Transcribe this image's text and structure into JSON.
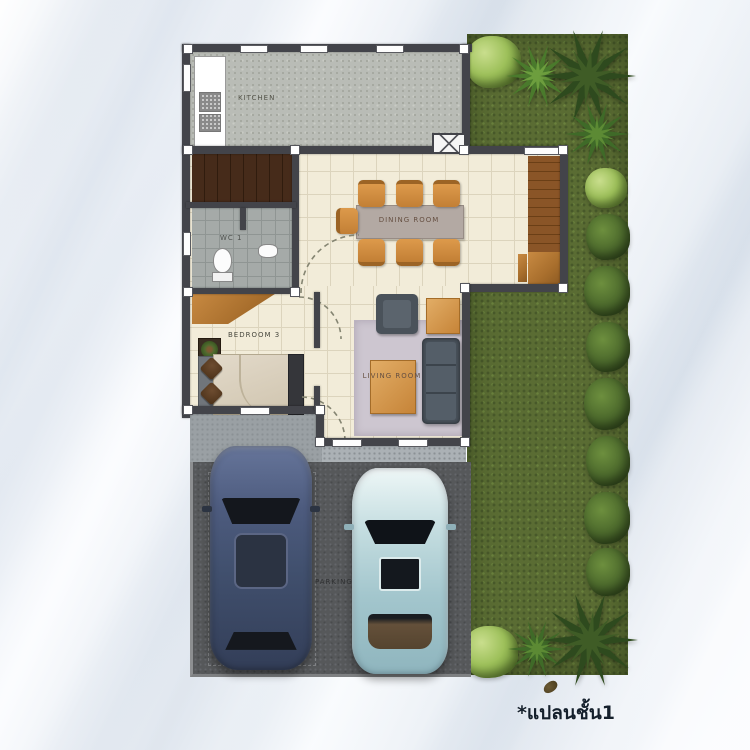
{
  "plan": {
    "caption": "*แปลนชั้น1",
    "rooms": {
      "kitchen": "KITCHEN",
      "dining": "DINING ROOM",
      "wc": "WC 1",
      "bedroom": "BEDROOM 3",
      "living": "LIVING ROOM",
      "parking": "PARKING"
    },
    "colors": {
      "sand_background": "#eef1f5",
      "grass": "#5a6c33",
      "wall": "#43444a",
      "tile_floor": "#f2ecd9",
      "kitchen_floor": "#b9bcb6",
      "wc_floor": "#a5aaa8",
      "stairs": "#3c2517",
      "wood_deck": "#7e4c20",
      "rug": "#cdc6d0",
      "sofa": "#49525b",
      "furniture_orange": "#cc8a3e",
      "parking_asphalt": "#56585a",
      "porch": "#9aa0a4",
      "car_blue": "#41506e",
      "car_light_blue": "#a3c6cd",
      "caption_text": "#15202c"
    },
    "objects": [
      "garden-lawn",
      "palm-tree",
      "shrub",
      "kitchen-counter-with-sink",
      "staircase",
      "toilet",
      "wash-basin",
      "dining-table-with-six-chairs",
      "wood-deck-terrace",
      "bed-with-pillows",
      "wardrobe",
      "potted-plant",
      "sofa",
      "armchair",
      "coffee-table",
      "side-table",
      "area-rug",
      "blue-suv-top-view",
      "light-blue-sedan-top-view"
    ]
  }
}
